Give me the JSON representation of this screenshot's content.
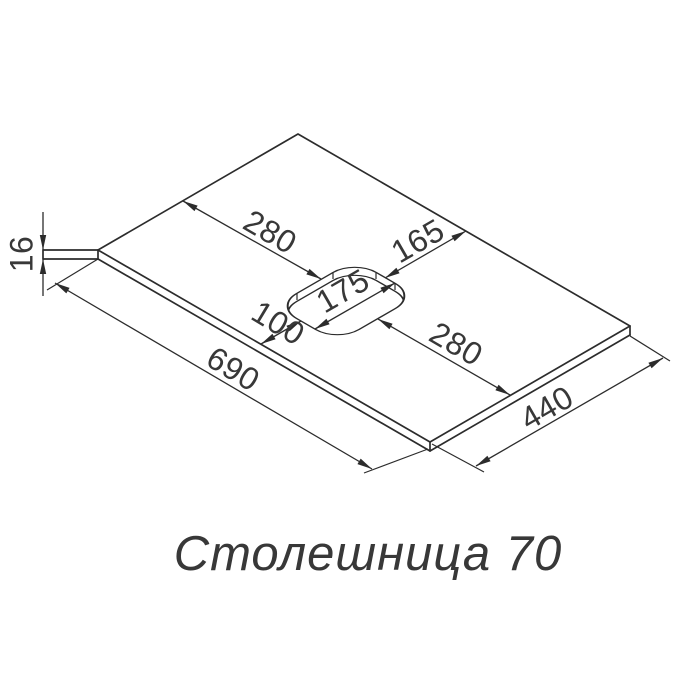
{
  "title": "Столешница 70",
  "colors": {
    "line": "#2c2c2c",
    "text": "#383838",
    "background": "#ffffff"
  },
  "dims": {
    "thickness": "16",
    "back_to_cutout": "280",
    "cutout_to_right": "165",
    "cutout_width": "175",
    "cutout_to_left": "100",
    "cutout_to_front": "280",
    "length": "690",
    "width": "440"
  }
}
